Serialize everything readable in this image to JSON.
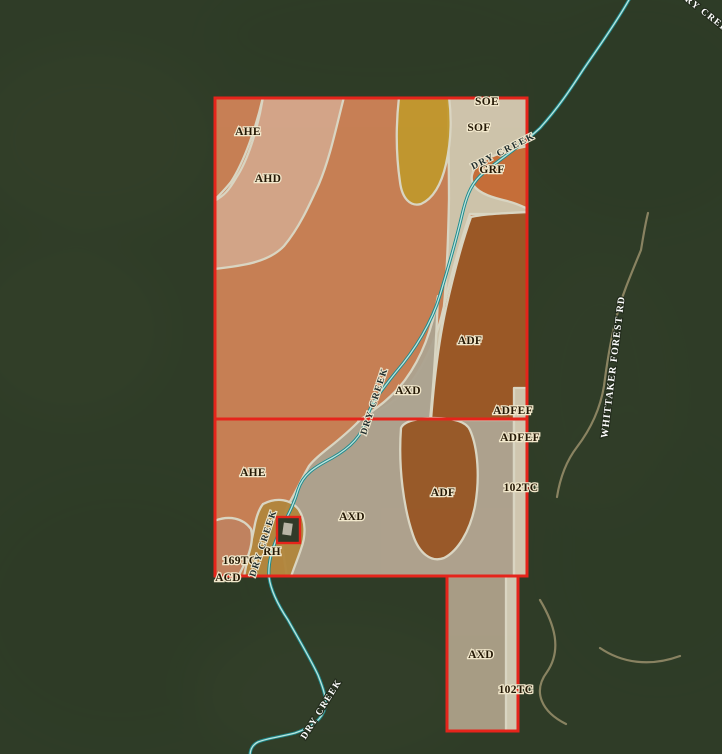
{
  "map": {
    "title": "Soil survey overlay on aerial imagery",
    "colors": {
      "boundary_red": "#E5241B",
      "creek_teal": "#1E8A8C",
      "creek_inner": "#CDEDE7",
      "soil_line_white": "#F4EDDA",
      "label_dark": "#241805",
      "label_halo": "#F2E8CC",
      "units": {
        "AHE": "#DE8A5C",
        "AHD": "#ECB79A",
        "SOF": "#E6DCC4",
        "GRF": "#DC7135",
        "ADF": "#A85B24",
        "AXD": "#BFB3A0",
        "RH": "#C5913F",
        "169TC": "#D68E68",
        "AXD_bottom": "#C2B29A",
        "strip_cream": "#E9E0C9",
        "unlabeled_yellow": "#D6A62E"
      }
    },
    "soil_labels": {
      "soe": "SOE",
      "ahe_top": "AHE",
      "ahd": "AHD",
      "sof": "SOF",
      "grf": "GRF",
      "adf_top": "ADF",
      "axd_top": "AXD",
      "adfef_upper": "ADFEF",
      "adfef_lower": "ADFEF",
      "tc102_right": "102TC",
      "ahe_mid": "AHE",
      "axd_mid": "AXD",
      "adf_mid": "ADF",
      "rh": "RH",
      "tc169": "169TC",
      "acd": "ACD",
      "axd_bottom": "AXD",
      "tc102_bottom": "102TC"
    },
    "feature_labels": {
      "creek": "DRY CREEK",
      "road": "WHITTAKER FOREST RD"
    }
  }
}
